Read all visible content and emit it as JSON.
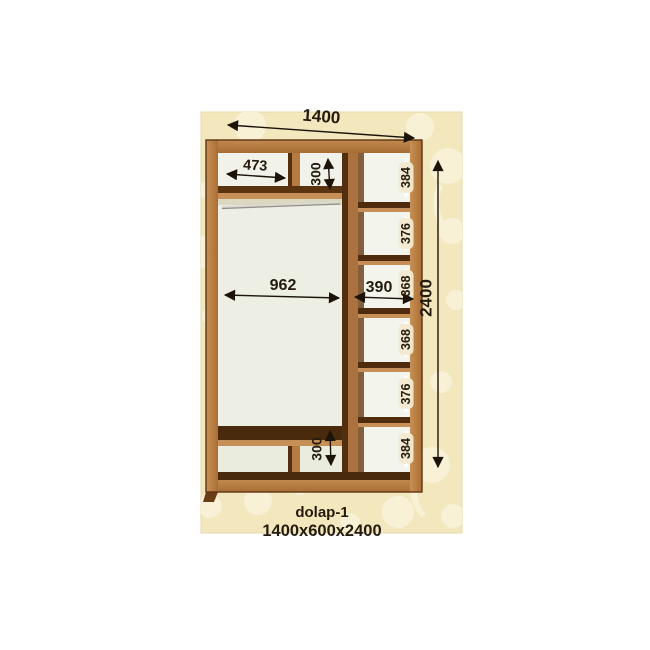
{
  "diagram": {
    "product_name": "dolap-1",
    "product_size": "1400x600x2400",
    "overall_width": "1400",
    "overall_height": "2400",
    "top_left_shelf_width": "473",
    "top_mid_section_height": "300",
    "main_section_width": "962",
    "right_column_width": "390",
    "bottom_mid_section_height": "300",
    "right_shelves": [
      "384",
      "376",
      "368",
      "368",
      "376",
      "384"
    ]
  },
  "colors": {
    "background": "#f2e7bd",
    "pattern": "#f8f1d6",
    "wood_face": "#b57b43",
    "wood_dark": "#4f2c0e",
    "interior": "#eef0e6",
    "dimension_text": "#241a0e"
  }
}
